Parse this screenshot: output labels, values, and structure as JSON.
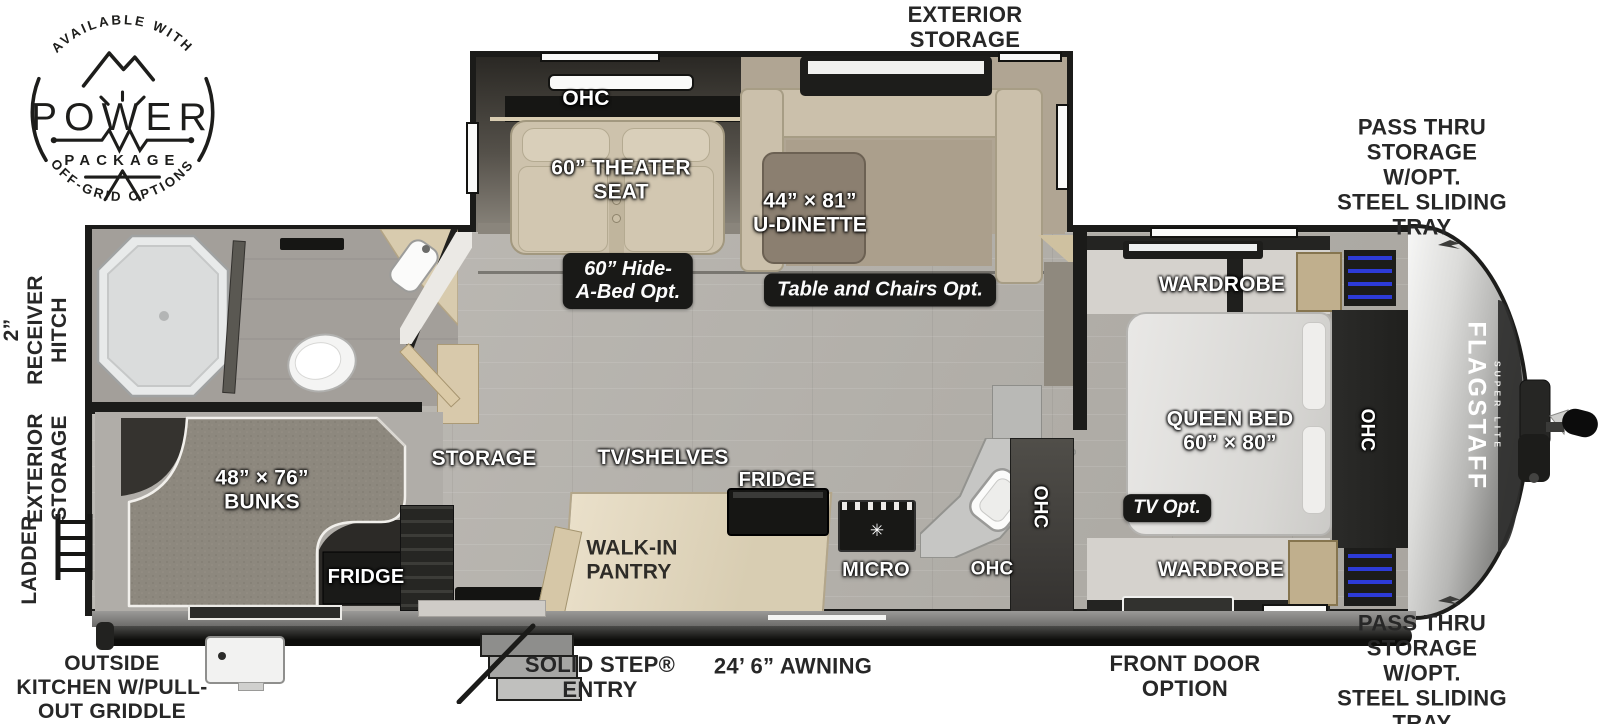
{
  "logo": {
    "arc_top": "AVAILABLE WITH",
    "title": "POWER",
    "subtitle": "PACKAGE",
    "arc_bottom": "OFF-GRID OPTIONS"
  },
  "exterior": {
    "storage_top": "EXTERIOR\nSTORAGE",
    "pass_thru_top": "PASS THRU\nSTORAGE W/OPT.\nSTEEL SLIDING TRAY",
    "pass_thru_bottom": "PASS THRU\nSTORAGE W/OPT.\nSTEEL SLIDING TRAY",
    "receiver_hitch": "2”\nRECEIVER\nHITCH",
    "storage_rear": "EXTERIOR\nSTORAGE",
    "ladder": "LADDER",
    "outside_kitchen": "OUTSIDE\nKITCHEN W/PULL-\nOUT GRIDDLE",
    "solid_step": "SOLID STEP®\nENTRY",
    "awning": "24’ 6” AWNING",
    "front_door": "FRONT DOOR\nOPTION"
  },
  "slide_out": {
    "ohc": "OHC",
    "theater_seat": "60” THEATER\nSEAT",
    "u_dinette": "44” × 81”\nU-DINETTE",
    "hide_a_bed_option": "60” Hide-\nA-Bed Opt.",
    "table_chairs_option": "Table and Chairs Opt."
  },
  "interior": {
    "bunks": "48” × 76”\nBUNKS",
    "bunk_fridge": "FRIDGE",
    "storage": "STORAGE",
    "tv_shelves": "TV/SHELVES",
    "fridge": "FRIDGE",
    "pantry": "WALK-IN\nPANTRY",
    "micro": "MICRO",
    "ohc_counter": "OHC",
    "ohc_tall": "OHC"
  },
  "bedroom": {
    "wardrobe_top": "WARDROBE",
    "wardrobe_bottom": "WARDROBE",
    "queen_bed": "QUEEN BED\n60” × 80”",
    "ohc": "OHC",
    "tv_option": "TV Opt."
  },
  "brand": {
    "name": "FLAGSTAFF",
    "series": "SUPER LITE"
  },
  "icons": {
    "stove_burner": "✳"
  },
  "colors": {
    "wall": "#1b1b19",
    "floor": "#b6b3ae",
    "badge": "#191917",
    "accent_blue": "#2d3bd8",
    "wood": "#c0af8d",
    "label_light": "#ffffff",
    "label_dark": "#272727"
  }
}
